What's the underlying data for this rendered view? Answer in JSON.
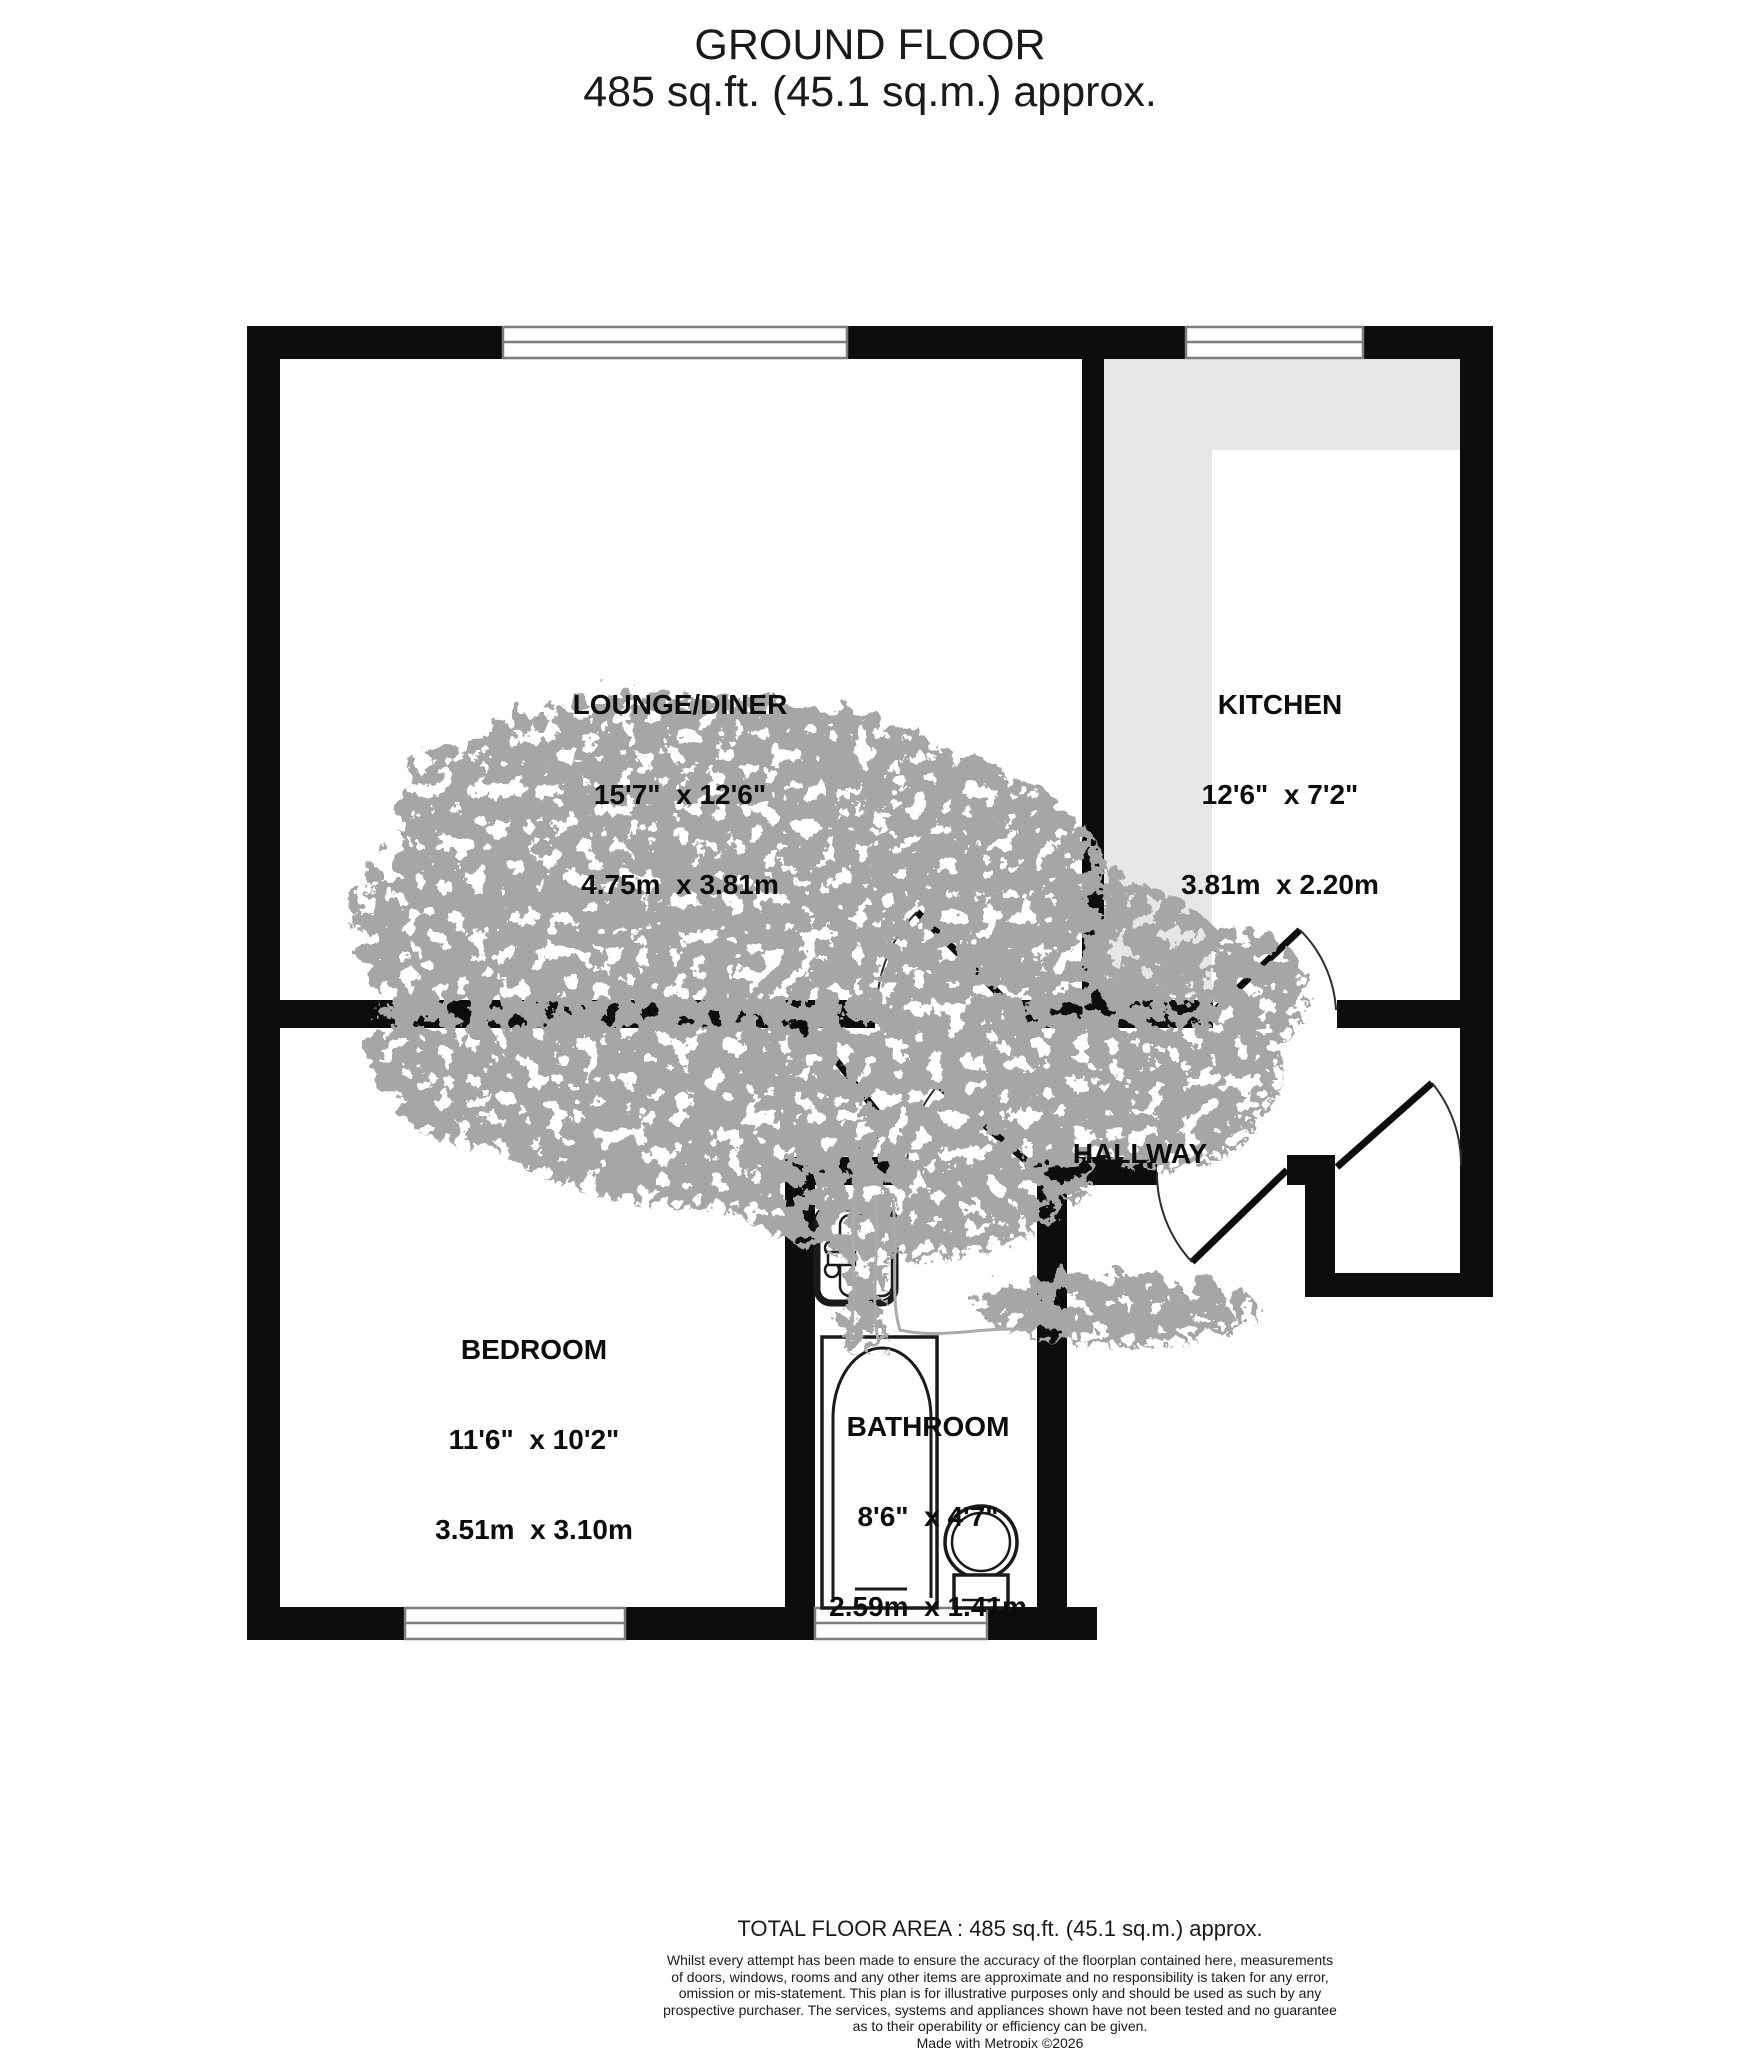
{
  "header": {
    "title": "GROUND FLOOR",
    "subtitle": "485 sq.ft. (45.1 sq.m.) approx."
  },
  "rooms": {
    "lounge": {
      "name": "LOUNGE/DINER",
      "imperial": "15'7\"  x 12'6\"",
      "metric": "4.75m  x 3.81m"
    },
    "kitchen": {
      "name": "KITCHEN",
      "imperial": "12'6\"  x 7'2\"",
      "metric": "3.81m  x 2.20m"
    },
    "bedroom": {
      "name": "BEDROOM",
      "imperial": "11'6\"  x 10'2\"",
      "metric": "3.51m  x 3.10m"
    },
    "bathroom": {
      "name": "BATHROOM",
      "imperial": "8'6\"  x 4'7\"",
      "metric": "2.59m  x 1.41m"
    },
    "hallway": {
      "name": "HALLWAY"
    },
    "storage": {
      "name": "STORAGE"
    }
  },
  "footer": {
    "total_area": "TOTAL FLOOR AREA : 485 sq.ft. (45.1 sq.m.) approx.",
    "disclaimer_lines": [
      "Whilst every attempt has been made to ensure the accuracy of the floorplan contained here, measurements",
      "of doors, windows, rooms and any other items are approximate and no responsibility is taken for any error,",
      "omission or mis-statement. This plan is for illustrative purposes only and should be used as such by any",
      "prospective purchaser. The services, systems and appliances shown have not been tested and no guarantee",
      "as to their operability or efficiency can be given."
    ],
    "credit": "Made with Metropix ©2026"
  },
  "colors": {
    "wall": "#0d0d0d",
    "counter": "#e6e6e6",
    "window_frame": "#7d7d7d",
    "tree": "#a6a6a6",
    "fixture_stroke": "#1a1a1a"
  }
}
